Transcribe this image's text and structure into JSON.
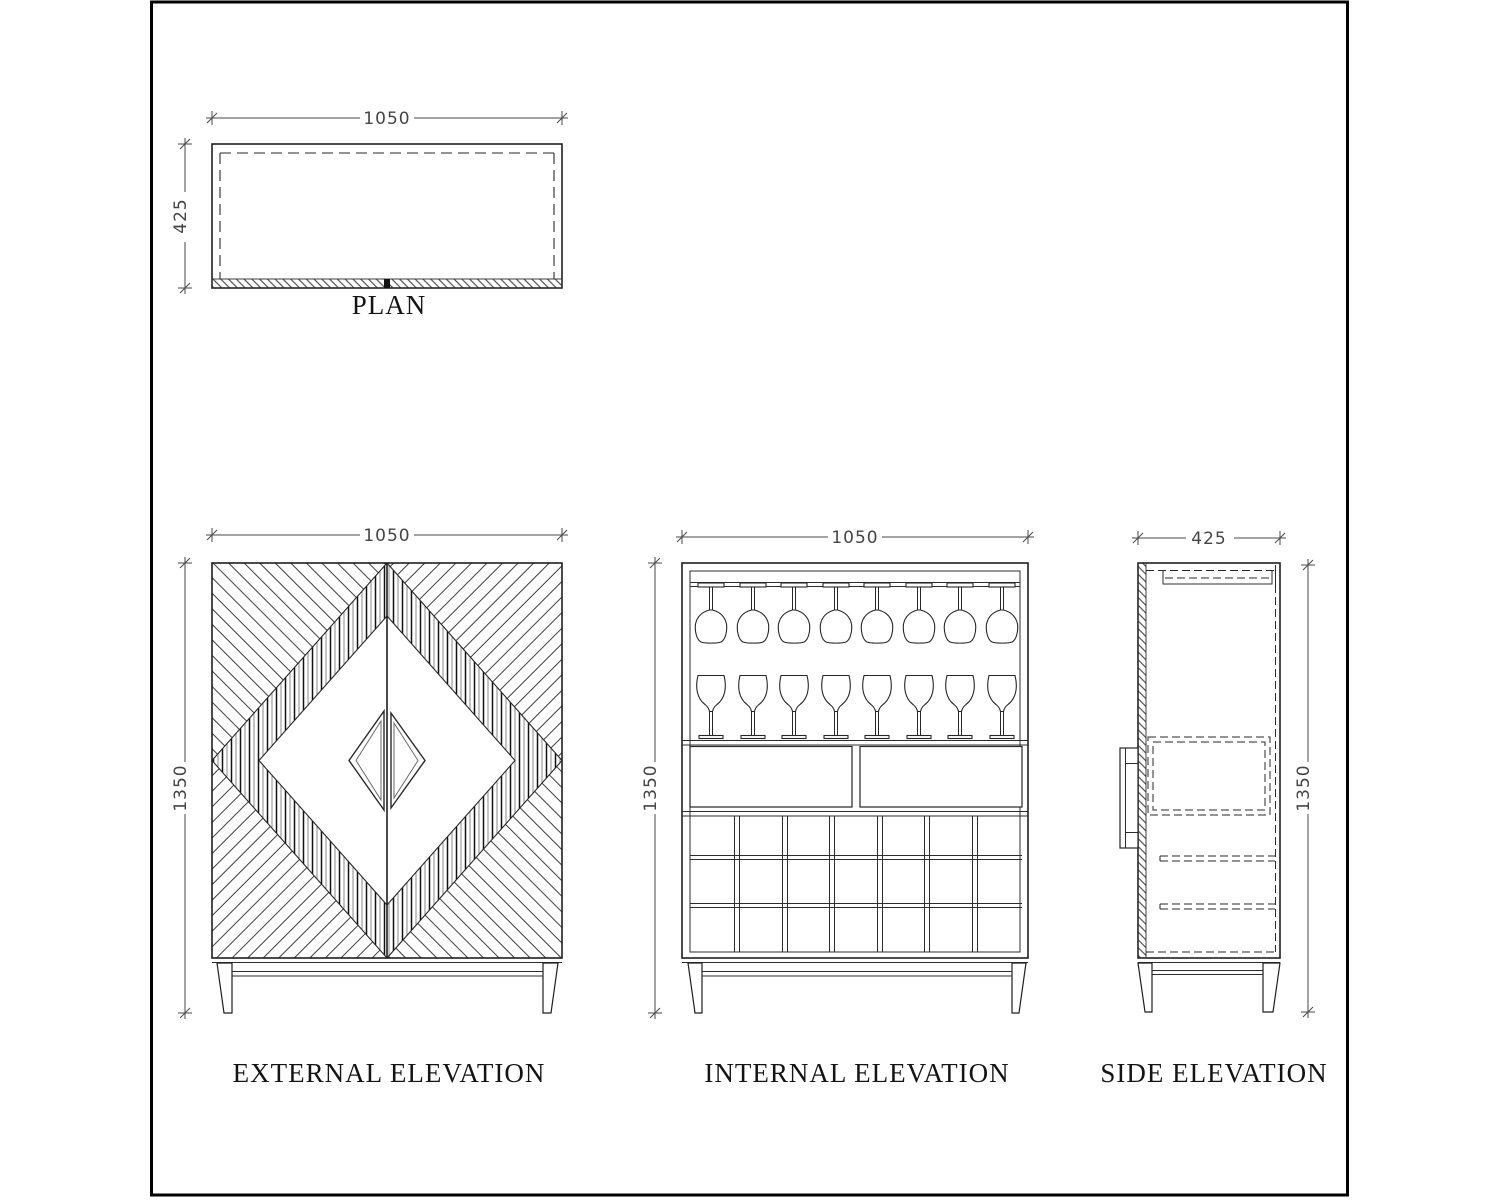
{
  "sheet": {
    "background": "#ffffff",
    "border_color": "#000000",
    "line_color": "#1f1f1f",
    "dim_text_color": "#454545"
  },
  "views": {
    "plan": {
      "label": "PLAN",
      "dim_width": "1050",
      "dim_depth": "425"
    },
    "external_elevation": {
      "label": "EXTERNAL ELEVATION",
      "dim_width": "1050",
      "dim_height": "1350"
    },
    "internal_elevation": {
      "label": "INTERNAL ELEVATION",
      "dim_width": "1050",
      "dim_height": "1350"
    },
    "side_elevation": {
      "label": "SIDE ELEVATION",
      "dim_width": "425",
      "dim_height": "1350"
    }
  }
}
